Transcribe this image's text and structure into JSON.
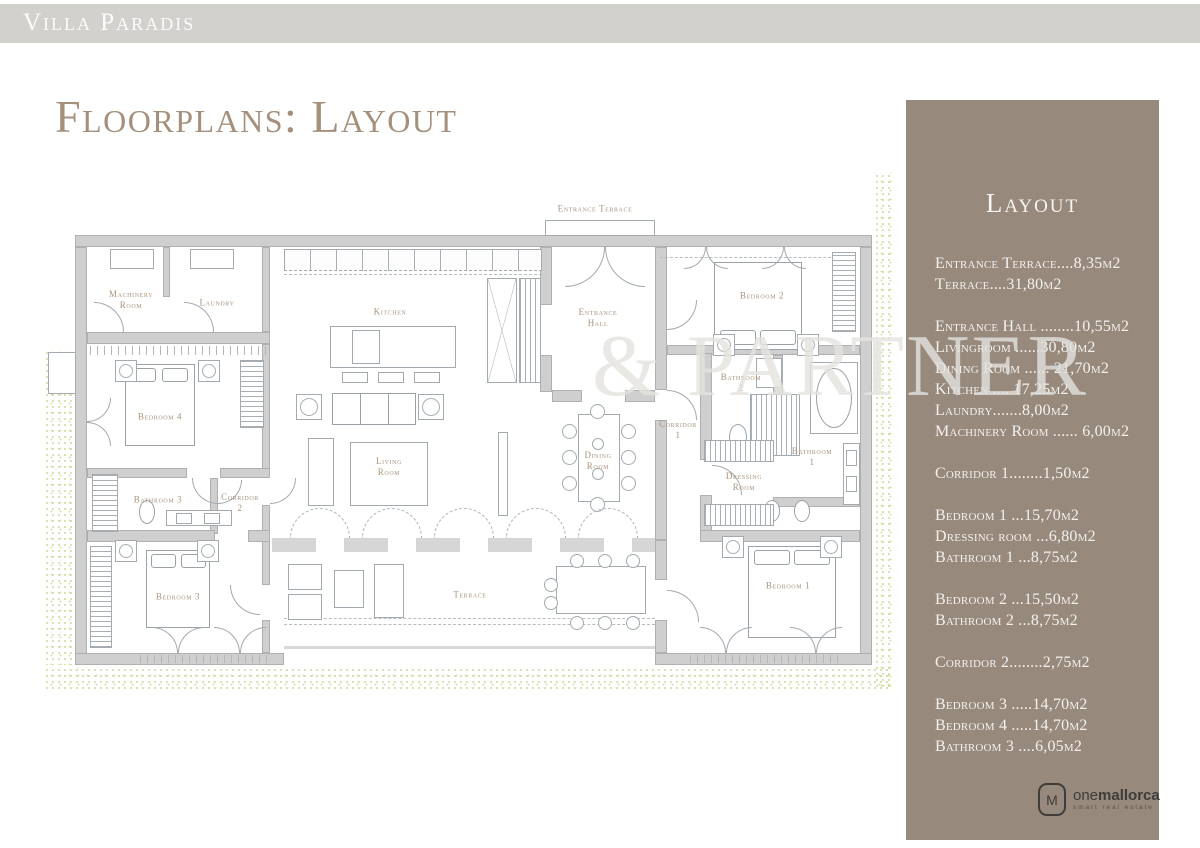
{
  "header": {
    "title": "Villa Paradis"
  },
  "page": {
    "title": "Floorplans: Layout"
  },
  "watermark": {
    "text": "& PARTNER"
  },
  "colors": {
    "accent": "#a5907d",
    "sidebar_bg": "#97897c",
    "topbar_bg": "#d3d1cd",
    "stipple": "#c7cd86"
  },
  "sidebar": {
    "title": "Layout",
    "groups": [
      [
        "Entrance Terrace....8,35m2",
        "Terrace....31,80m2"
      ],
      [
        "Entrance Hall ........10,55m2",
        "Livingroom ......30,80m2",
        "Dining Room ...... 21,70m2",
        "Kitchen .... 17,25m2",
        "Laundry.......8,00m2",
        "Machinery Room ...... 6,00m2"
      ],
      [
        "Corridor 1........1,50m2"
      ],
      [
        "Bedroom 1 ...15,70m2",
        "Dressing room ...6,80m2",
        "Bathroom 1 ...8,75m2"
      ],
      [
        "Bedroom 2 ...15,50m2",
        "Bathroom 2 ...8,75m2"
      ],
      [
        "Corridor 2........2,75m2"
      ],
      [
        "Bedroom 3 .....14,70m2",
        "Bedroom 4 .....14,70m2",
        "Bathroom 3 ....6,05m2"
      ]
    ],
    "logo": {
      "mark": "M",
      "name_light": "one",
      "name_bold": "mallorca",
      "tagline": "smart real estate"
    }
  },
  "plan": {
    "rooms": [
      {
        "id": "entrance-terrace",
        "x": 595,
        "y": 209,
        "lines": [
          "Entrance Terrace"
        ]
      },
      {
        "id": "machinery-room",
        "x": 131,
        "y": 300,
        "lines": [
          "Machinery",
          "Room"
        ]
      },
      {
        "id": "laundry",
        "x": 217,
        "y": 303,
        "lines": [
          "Laundry"
        ]
      },
      {
        "id": "kitchen",
        "x": 390,
        "y": 312,
        "lines": [
          "Kitchen"
        ]
      },
      {
        "id": "entrance-hall",
        "x": 598,
        "y": 318,
        "lines": [
          "Entrance",
          "Hall"
        ]
      },
      {
        "id": "bedroom-2",
        "x": 762,
        "y": 296,
        "lines": [
          "Bedroom 2"
        ]
      },
      {
        "id": "bedroom-4",
        "x": 160,
        "y": 417,
        "lines": [
          "Bedroom 4"
        ]
      },
      {
        "id": "bathroom-3",
        "x": 158,
        "y": 500,
        "lines": [
          "Bathroom 3"
        ]
      },
      {
        "id": "corridor-2",
        "x": 240,
        "y": 503,
        "lines": [
          "Corridor",
          "2"
        ]
      },
      {
        "id": "living-room",
        "x": 389,
        "y": 467,
        "lines": [
          "Living",
          "Room"
        ]
      },
      {
        "id": "dining-room",
        "x": 598,
        "y": 461,
        "lines": [
          "Dining",
          "Room"
        ]
      },
      {
        "id": "corridor-1",
        "x": 678,
        "y": 430,
        "lines": [
          "Corridor",
          "1"
        ]
      },
      {
        "id": "bathroom-2",
        "x": 741,
        "y": 383,
        "lines": [
          "Bathroom",
          "2"
        ]
      },
      {
        "id": "bathroom-1",
        "x": 812,
        "y": 457,
        "lines": [
          "Bathroom",
          "1"
        ]
      },
      {
        "id": "dressing-room",
        "x": 744,
        "y": 482,
        "lines": [
          "Dressing",
          "Room"
        ]
      },
      {
        "id": "bedroom-3",
        "x": 178,
        "y": 597,
        "lines": [
          "Bedroom 3"
        ]
      },
      {
        "id": "bedroom-1",
        "x": 788,
        "y": 586,
        "lines": [
          "Bedroom 1"
        ]
      },
      {
        "id": "terrace",
        "x": 470,
        "y": 595,
        "lines": [
          "Terrace"
        ]
      }
    ]
  }
}
